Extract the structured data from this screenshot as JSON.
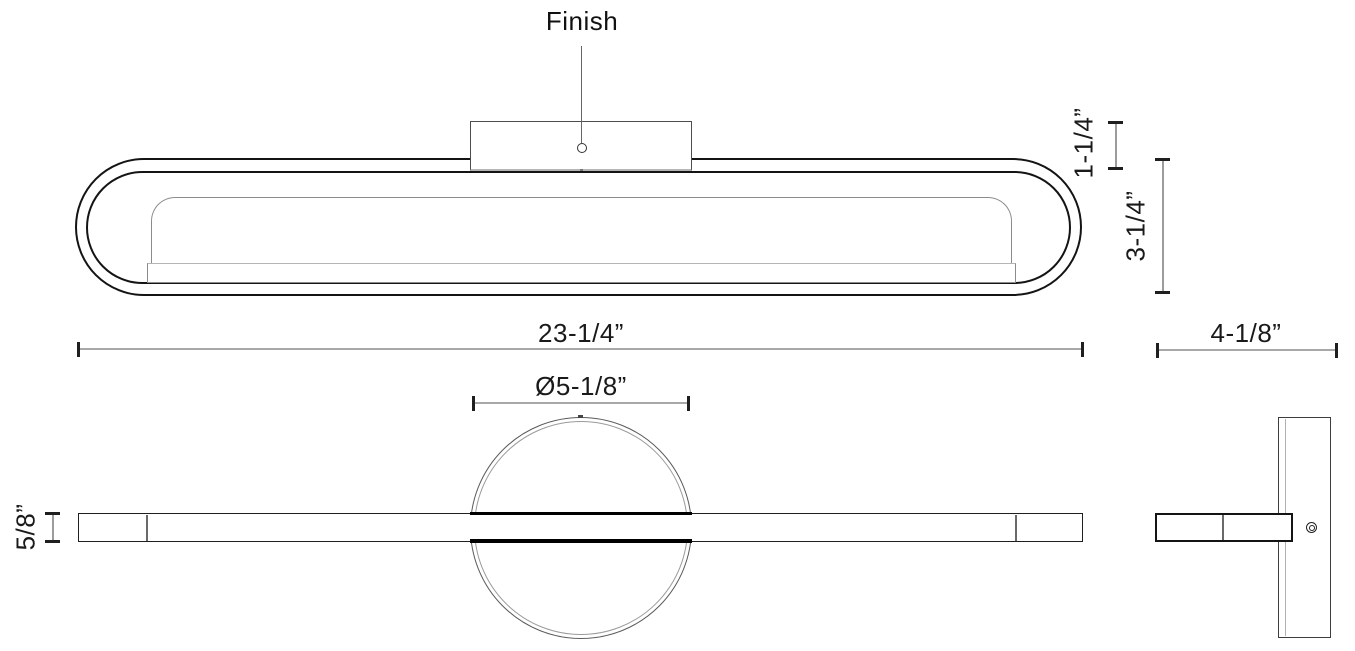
{
  "labels": {
    "finish_callout": "Finish"
  },
  "dimensions": {
    "fixture_width": "23-1/4”",
    "fixture_height": "3-1/4”",
    "mount_depth": "1-1/4”",
    "canopy_diameter": "Ø5-1/8”",
    "bar_thickness": "5/8”",
    "overall_depth": "4-1/8”"
  },
  "colors": {
    "outline": "#141414",
    "secondary_line": "#8c8c8c",
    "dimension_line": "#a8a8a8",
    "tick": "#1f1f1f",
    "background": "#ffffff"
  }
}
